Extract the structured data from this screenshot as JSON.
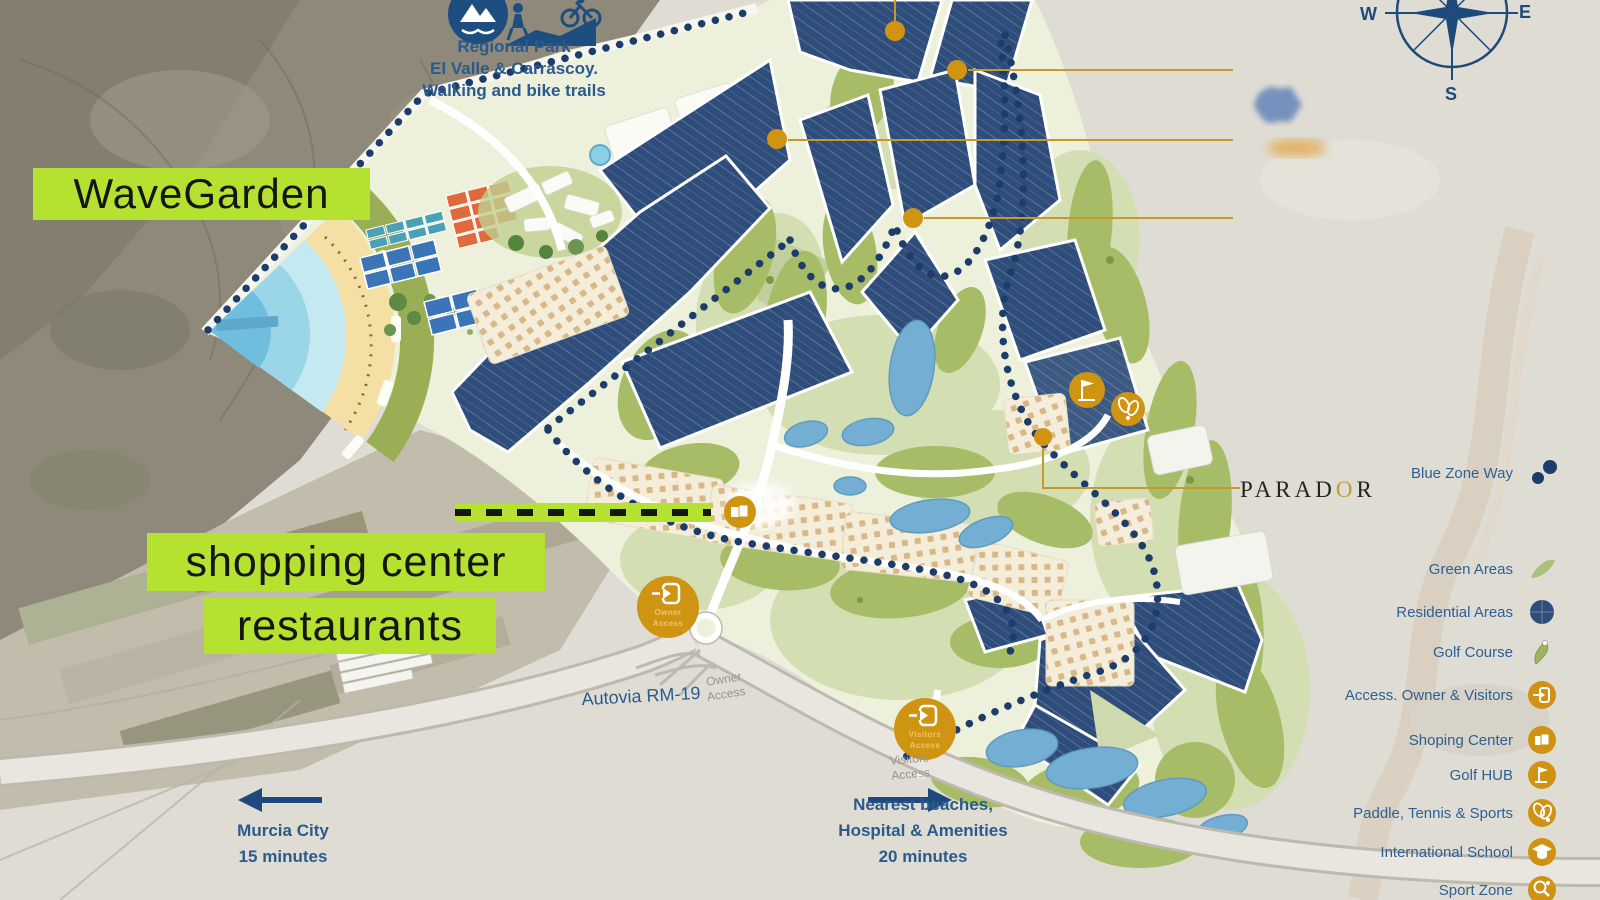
{
  "header_note": {
    "line1": "Regional Park",
    "line2": "El Valle & Carrascoy.",
    "line3": "Walking and bike trails"
  },
  "highlights": {
    "wavegarden": "WaveGarden",
    "shopping": "shopping center",
    "restaurants": "restaurants"
  },
  "map_labels": {
    "parador": "PARADOR",
    "parador_pre": "PARAD",
    "parador_o": "O",
    "parador_post": "R",
    "autovia": "Autovia RM-19",
    "owner_road_1": "Owner",
    "owner_road_2": "Access",
    "visitors_road_1": "Visitors",
    "visitors_road_2": "Access",
    "owner_badge_1": "Owner",
    "owner_badge_2": "Access",
    "visitors_badge_1": "Visitors",
    "visitors_badge_2": "Access"
  },
  "directions": {
    "murcia_1": "Murcia City",
    "murcia_2": "15 minutes",
    "beaches_1": "Nearest beaches,",
    "beaches_2": "Hospital & Amenities",
    "beaches_3": "20 minutes"
  },
  "compass": {
    "west": "W",
    "east": "E",
    "south": "S"
  },
  "legend": {
    "items": [
      {
        "label": "Blue Zone Way",
        "icon": "blue-dots-icon"
      },
      {
        "label": "Green Areas",
        "icon": "green-area-icon"
      },
      {
        "label": "Residential Areas",
        "icon": "residential-circle-icon"
      },
      {
        "label": "Golf Course",
        "icon": "golf-course-icon"
      },
      {
        "label": "Access. Owner & Visitors",
        "icon": "enter-icon"
      },
      {
        "label": "Shoping Center",
        "icon": "shopping-bag-icon"
      },
      {
        "label": "Golf HUB",
        "icon": "golf-flag-icon"
      },
      {
        "label": "Paddle, Tennis & Sports",
        "icon": "rackets-icon"
      },
      {
        "label": "International School",
        "icon": "graduation-cap-icon"
      },
      {
        "label": "Sport Zone",
        "icon": "sport-racket-icon"
      }
    ]
  },
  "colors": {
    "accent_gold": "#D09413",
    "residential_navy": "#2E4D7B",
    "highlight_green": "#B5E230",
    "text_blue": "#2B5A8C",
    "dotted_navy": "#1C3C6A",
    "site_green": "#EDF1DC"
  }
}
